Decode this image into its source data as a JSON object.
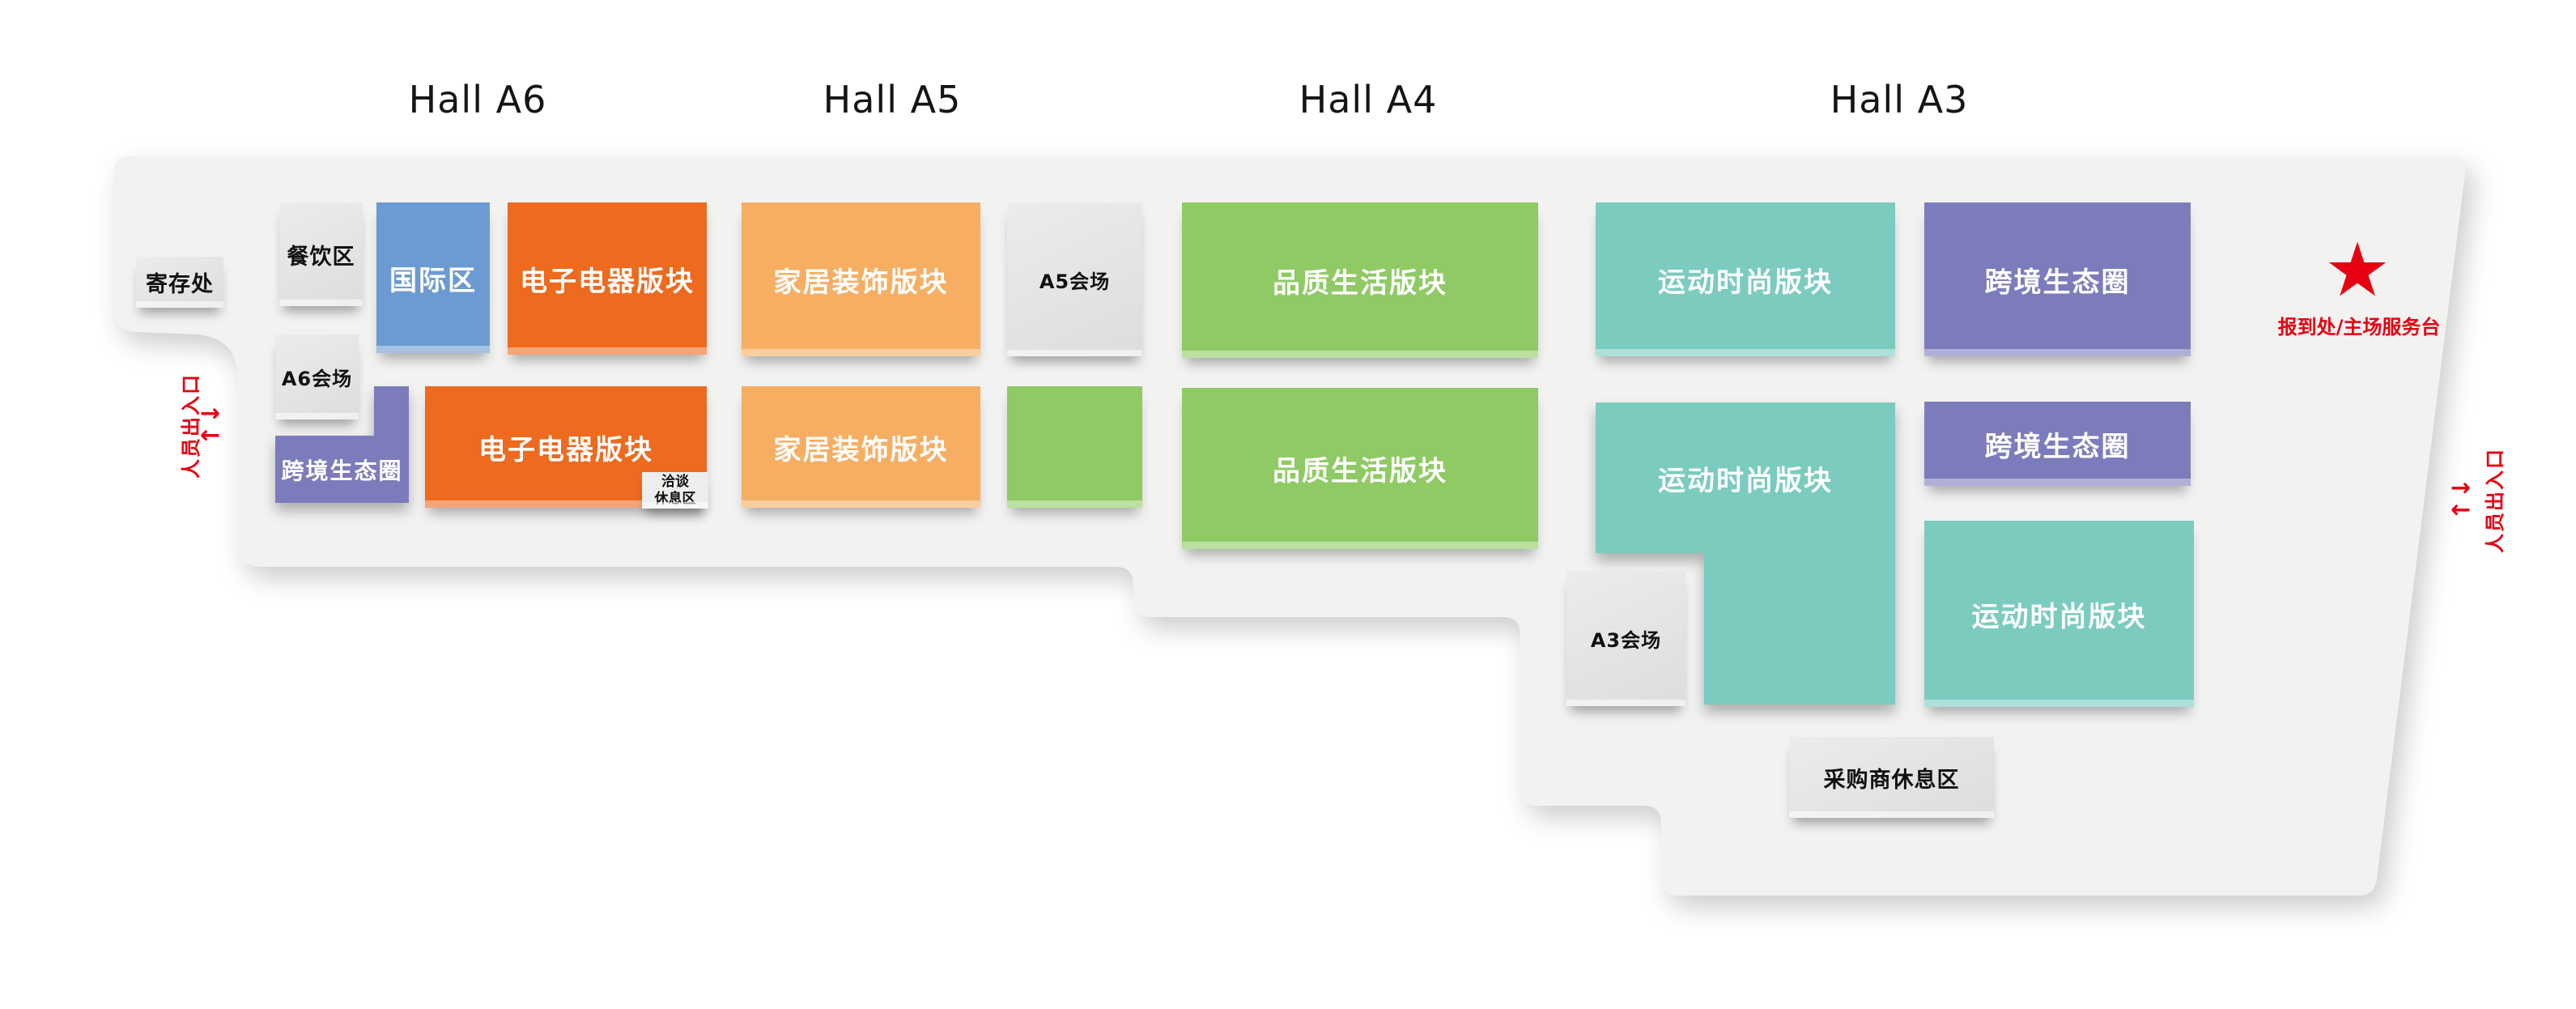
{
  "halls": [
    {
      "label": "Hall A6"
    },
    {
      "label": "Hall A5"
    },
    {
      "label": "Hall A4"
    },
    {
      "label": "Hall A3"
    }
  ],
  "areas": {
    "luggage": {
      "label": "寄存处"
    },
    "dining": {
      "label": "餐饮区"
    },
    "international": {
      "label": "国际区"
    },
    "electronics_top": {
      "label": "电子电器版块"
    },
    "a6_meeting": {
      "label": "A6会场"
    },
    "a6_cross_border": {
      "label": "跨境生态圈"
    },
    "electronics_bottom": {
      "label": "电子电器版块"
    },
    "negotiation_rest": {
      "lines": [
        "洽谈",
        "休息区"
      ]
    },
    "home_decor_top": {
      "label": "家居装饰版块"
    },
    "a5_meeting": {
      "label": "A5会场"
    },
    "home_decor_bottom": {
      "label": "家居装饰版块"
    },
    "quality_life_top": {
      "label": "品质生活版块"
    },
    "quality_life_bottom": {
      "label": "品质生活版块"
    },
    "sports_fashion_top": {
      "label": "运动时尚版块"
    },
    "sports_fashion_mid": {
      "label": "运动时尚版块"
    },
    "sports_fashion_bottom": {
      "label": "运动时尚版块"
    },
    "a3_cross_border_top": {
      "label": "跨境生态圈"
    },
    "a3_cross_border_bottom": {
      "label": "跨境生态圈"
    },
    "a3_meeting": {
      "label": "A3会场"
    },
    "buyer_lounge": {
      "label": "采购商休息区"
    }
  },
  "annotations": {
    "service_desk": {
      "icon": "★",
      "label": "报到处/主场服务台"
    },
    "entrance_left": {
      "label": "人员出入口",
      "arrow_out": "→",
      "arrow_in": "←"
    },
    "entrance_right": {
      "label": "人员出入口",
      "arrow_out": "→",
      "arrow_in": "←"
    }
  },
  "colors": {
    "orange": "#ED6A1E",
    "light_orange": "#F6AE63",
    "blue": "#6B9BD2",
    "purple": "#7C7CBC",
    "green": "#8FCA64",
    "teal": "#7BCBBF",
    "floor": "#F2F2F1",
    "red": "#E60012"
  }
}
